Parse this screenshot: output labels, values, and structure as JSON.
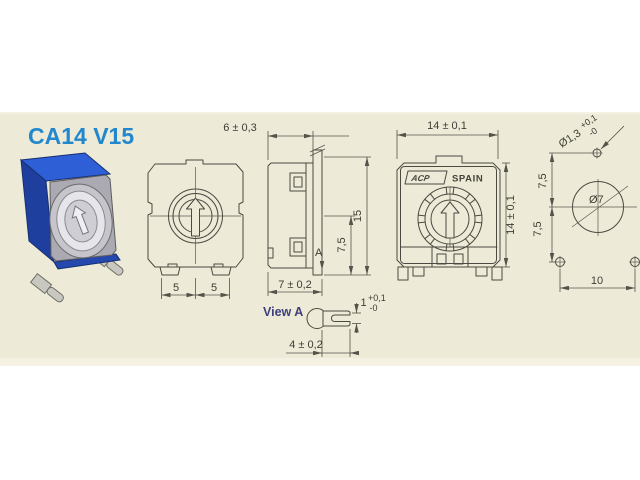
{
  "title": "CA14 V15",
  "colors": {
    "page_background": "#ffffff",
    "panel_background": "#edead8",
    "panel_edge_light": "#f5f2e4",
    "line": "#4b4a41",
    "dimension_text": "#3e3d33",
    "title_blue": "#2287cd",
    "view_label_navy": "#3f3f7d",
    "body_blue": "#2f5fd6",
    "body_blue_dark": "#1f3f9e",
    "body_blue_strip": "#2448ad",
    "face_gray": "#abaab2",
    "rotor_ring_gray": "#c6c5cb",
    "rotor_ring_light": "#e6e5e9",
    "pin_gray": "#c9c8c0"
  },
  "dimensions": {
    "front": {
      "pin_pitch_left": "5",
      "pin_pitch_right": "5"
    },
    "side": {
      "body_width": "6 ± 0,3",
      "half_height": "7,5",
      "total_height": "15",
      "body_depth": "7 ± 0,2",
      "section_marker": "A"
    },
    "back": {
      "body_width": "14 ± 0,1",
      "body_height": "14 ± 0,1"
    },
    "mounting": {
      "shaft_hole_diameter": "Ø1,3",
      "shaft_hole_tol_plus": "+0,1",
      "shaft_hole_tol_minus": "-0",
      "rotor_diameter": "Ø7",
      "vertical_offset_upper": "7,5",
      "vertical_offset_lower": "7,5",
      "hole_pitch": "10"
    },
    "view_a": {
      "label": "View A",
      "slot_width": "1",
      "slot_tol_plus": "+0,1",
      "slot_tol_minus": "-0",
      "lever_width": "4 ± 0,2"
    }
  },
  "markings": {
    "brand": "ACP",
    "origin": "SPAIN"
  }
}
